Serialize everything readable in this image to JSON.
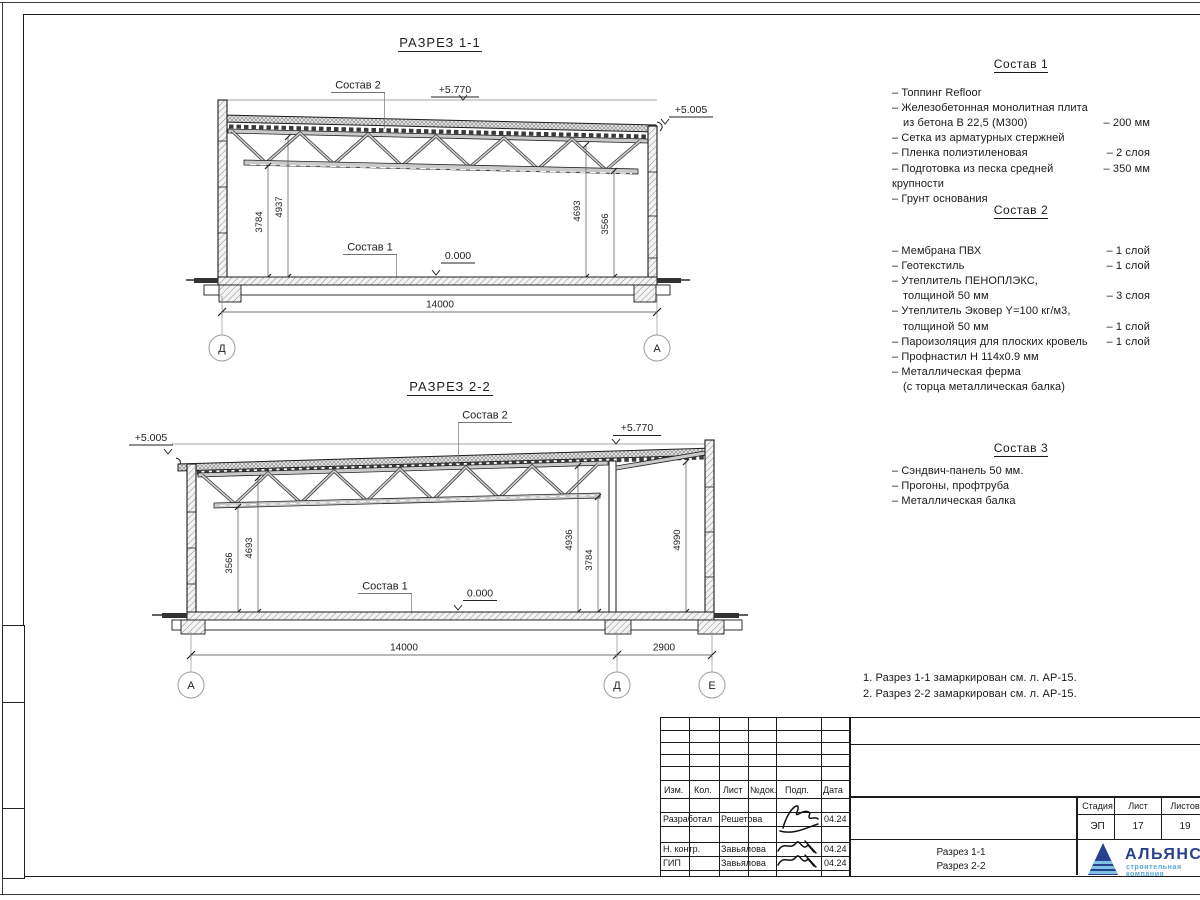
{
  "section1": {
    "title": "РАЗРЕЗ 1-1",
    "label_sostav2": "Состав 2",
    "label_sostav1": "Состав 1",
    "elev_top": "+5.770",
    "elev_right": "+5.005",
    "elev_zero": "0.000",
    "dim_left_a": "3784",
    "dim_left_b": "4937",
    "dim_right_a": "4693",
    "dim_right_b": "3566",
    "dim_span": "14000",
    "axis_left": "Д",
    "axis_right": "А"
  },
  "section2": {
    "title": "РАЗРЕЗ 2-2",
    "label_sostav2": "Состав 2",
    "label_sostav1": "Состав 1",
    "elev_top": "+5.770",
    "elev_left": "+5.005",
    "elev_zero": "0.000",
    "dim_l_a": "3566",
    "dim_l_b": "4693",
    "dim_m_a": "4936",
    "dim_m_b": "3784",
    "dim_r": "4990",
    "dim_span": "14000",
    "dim_span2": "2900",
    "axis_left": "А",
    "axis_mid": "Д",
    "axis_right": "Е"
  },
  "compositions": [
    {
      "title": "Состав 1",
      "items": [
        {
          "lines": [
            "– Топпинг Refloor"
          ],
          "value": ""
        },
        {
          "lines": [
            "– Железобетонная  монолитная плита",
            "из бетона В 22,5 (М300)"
          ],
          "value": "– 200 мм"
        },
        {
          "lines": [
            "– Сетка из арматурных стержней"
          ],
          "value": ""
        },
        {
          "lines": [
            "– Пленка полиэтиленовая"
          ],
          "value": "– 2 слоя"
        },
        {
          "lines": [
            "– Подготовка из песка средней крупности"
          ],
          "value": "– 350 мм"
        },
        {
          "lines": [
            "– Грунт основания"
          ],
          "value": ""
        }
      ]
    },
    {
      "title": "Состав 2",
      "items": [
        {
          "lines": [
            "– Мембрана ПВХ"
          ],
          "value": "– 1 слой"
        },
        {
          "lines": [
            "– Геотекстиль"
          ],
          "value": "– 1 слой"
        },
        {
          "lines": [
            "– Утеплитель ПЕНОПЛЭКС,",
            "толщиной 50 мм"
          ],
          "value": "– 3 слоя"
        },
        {
          "lines": [
            "– Утеплитель Эковер Y=100 кг/м3,",
            "толщиной 50 мм"
          ],
          "value": "– 1 слой"
        },
        {
          "lines": [
            "– Пароизоляция для плоских кровель"
          ],
          "value": "– 1 слой"
        },
        {
          "lines": [
            "– Профнастил Н 114х0.9 мм"
          ],
          "value": ""
        },
        {
          "lines": [
            "– Металлическая ферма",
            "(с торца металлическая балка)"
          ],
          "value": ""
        }
      ]
    },
    {
      "title": "Состав 3",
      "items": [
        {
          "lines": [
            "– Сэндвич-панель 50 мм."
          ],
          "value": ""
        },
        {
          "lines": [
            "– Прогоны, профтруба"
          ],
          "value": ""
        },
        {
          "lines": [
            "– Металлическая балка"
          ],
          "value": ""
        }
      ]
    }
  ],
  "notes": [
    "1. Разрез 1-1 замаркирован см. л. АР-15.",
    "2. Разрез 2-2 замаркирован см. л. АР-15."
  ],
  "titleblock": {
    "col_izm": "Изм.",
    "col_kol": "Кол.",
    "col_list": "Лист",
    "col_ndok": "№док.",
    "col_podp": "Подп.",
    "col_data": "Дата",
    "rows": [
      {
        "role": "Разработал",
        "name": "Решетова",
        "date": "04.24"
      },
      {
        "role": "Н. контр.",
        "name": "Завьялова",
        "date": "04.24"
      },
      {
        "role": "ГИП",
        "name": "Завьялова",
        "date": "04.24"
      }
    ],
    "doc_line1": "Разрез 1-1",
    "doc_line2": "Разрез 2-2",
    "stage_label": "Стадия",
    "sheet_label": "Лист",
    "sheets_label": "Листов",
    "stage": "ЭП",
    "sheet": "17",
    "sheets": "19",
    "company": "АЛЬЯНС",
    "company_sub": "строительная компания"
  },
  "colors": {
    "logo_blue": "#27418f",
    "logo_light": "#66aede",
    "line": "#1f1f1f"
  }
}
